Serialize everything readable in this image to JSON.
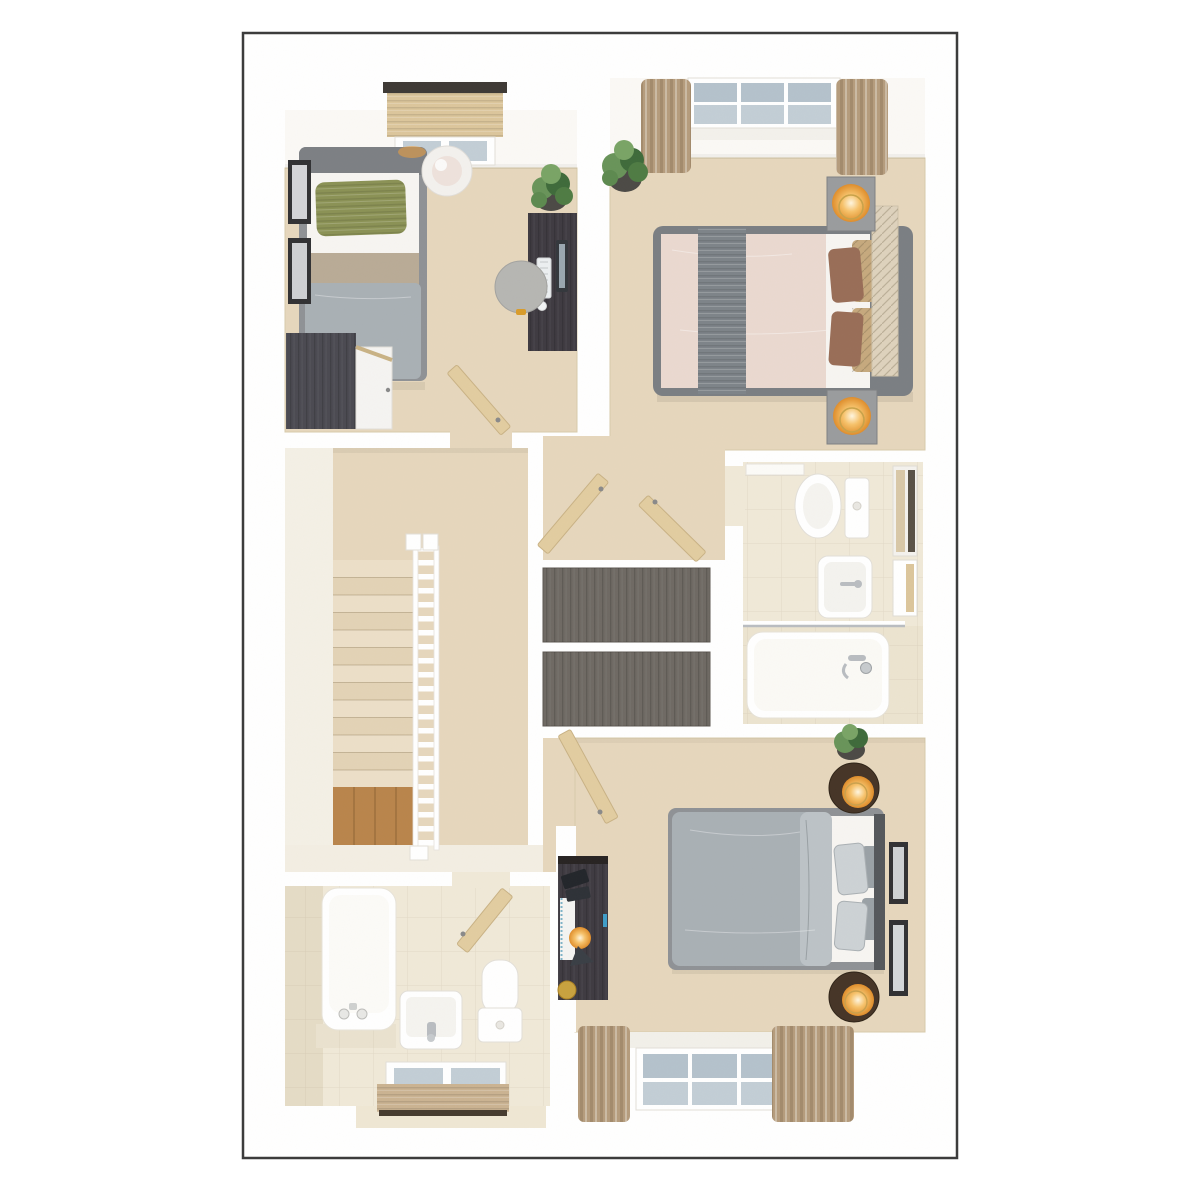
{
  "figure": {
    "type": "3d-floor-plan",
    "description": "Top-down 3D dollhouse render of a house upper floor with three bedrooms, bathroom, en-suite, built-in cupboards and staircase landing",
    "text_labels": []
  },
  "canvas": {
    "width": 1200,
    "height": 1200,
    "page_bg": "#ffffff"
  },
  "card": {
    "x": 243,
    "y": 33,
    "width": 714,
    "height": 1125,
    "fill": "#ffffff",
    "border_color": "#3b3b3b",
    "border_width": 2.5
  },
  "palette": {
    "carpet": "#e6d7bd",
    "carpet_light": "#ecdfc8",
    "carpet_shade": "#d9c7a6",
    "floor_pale": "#f4f0e6",
    "wall": "#ffffff",
    "wall_face": "#fbf9f6",
    "wall_edge": "#e3dfd7",
    "tile": "#f0e9d8",
    "tile_dark": "#e5dcc6",
    "tile_ledge": "#eae2cf",
    "wood_dark": "#4b4a52",
    "wood_desk": "#3f3b42",
    "wood_mid": "#6f6a64",
    "wood_light": "#dcc69c",
    "wood_floor": "#b9854c",
    "door_wood": "#e2cda1",
    "bedframe": "#8f9296",
    "bedframe_dark": "#7b7f83",
    "headboard": "#ded2bd",
    "headboard_dark": "#55585c",
    "linen": "#f7f5f2",
    "duvet": "#a9b0b5",
    "duvet_light": "#bcc3c7",
    "blush": "#ead9d0",
    "runner": "#7e8489",
    "pillow_green": "#8b9256",
    "pillow_brown": "#996e58",
    "pillow_tan": "#c6a97e",
    "pillow_gray": "#cdd2d5",
    "curtain": "#b59c7d",
    "curtain_dark": "#8f7759",
    "nightstand": "#9a9c9e",
    "nightstand_round": "#463527",
    "glow": "#f0a13e",
    "glow_mid": "#f7c36c",
    "glow_core": "#fff6e0",
    "plant": "#69945a",
    "plant_dark": "#3f6b3b",
    "pot": "#4c4a46",
    "chrome": "#b9bdc1",
    "white_fixture": "#ffffff",
    "fixture_line": "#e2dfd8",
    "frame_dark": "#323234",
    "pelmet": "#3e3a35",
    "pane": "#c3ced6",
    "pane_cool": "#b4c2cc"
  },
  "rooms": [
    {
      "id": "bedroom-single",
      "position": "top-left",
      "furniture": [
        "single-bed",
        "green-cushion",
        "grey-duvet",
        "taupe-throw",
        "wardrobe",
        "wardrobe-door",
        "desk",
        "computer-monitor",
        "keyboard",
        "mouse",
        "desk-stool",
        "potted-plant",
        "pendant-lamp",
        "wall-picture",
        "wall-picture",
        "window-with-blind",
        "open-door"
      ]
    },
    {
      "id": "master-bedroom",
      "position": "top-right",
      "furniture": [
        "double-bed",
        "blush-duvet",
        "grey-runner",
        "brown-cushion",
        "brown-cushion",
        "tan-quilted-cushion",
        "tan-quilted-cushion",
        "quilted-headboard",
        "bedside-table-with-lamp",
        "bedside-table-with-lamp",
        "potted-plant",
        "window-with-curtains"
      ]
    },
    {
      "id": "dressing-area",
      "position": "center",
      "furniture": [
        "built-in-cupboard",
        "built-in-cupboard",
        "open-cupboard-door",
        "open-cupboard-door"
      ]
    },
    {
      "id": "en-suite",
      "position": "center-right",
      "furniture": [
        "toilet",
        "basin",
        "bath",
        "shower-screen",
        "bath-mixer-tap",
        "mirror-cabinet",
        "towel-shelf",
        "open-door"
      ]
    },
    {
      "id": "landing",
      "position": "center-left",
      "furniture": [
        "staircase",
        "balustrade",
        "newel-posts",
        "wood-floor-half-landing"
      ]
    },
    {
      "id": "bedroom-double",
      "position": "bottom-right",
      "furniture": [
        "double-bed",
        "grey-duvet",
        "folded-duvet-flap",
        "grey-cushions",
        "headboard",
        "round-bedside-table-with-lamp",
        "round-bedside-table-with-lamp",
        "desk",
        "desk-lamp",
        "spiral-notebook",
        "gold-dish",
        "wall-picture",
        "wall-picture",
        "potted-plant",
        "window-with-curtains",
        "open-door"
      ]
    },
    {
      "id": "bathroom",
      "position": "bottom-left",
      "furniture": [
        "bath",
        "bath-taps",
        "basin",
        "toilet",
        "tiled-ledge",
        "window-with-roller-blind",
        "open-door"
      ]
    }
  ],
  "counts": {
    "stair_treads": 13,
    "master_window_panes": 6,
    "double_bedroom_window_panes": 6,
    "single_bedroom_window_panes": 2,
    "bathroom_window_panes": 2,
    "wall_pictures_total": 4,
    "glowing_lamps": 5
  }
}
